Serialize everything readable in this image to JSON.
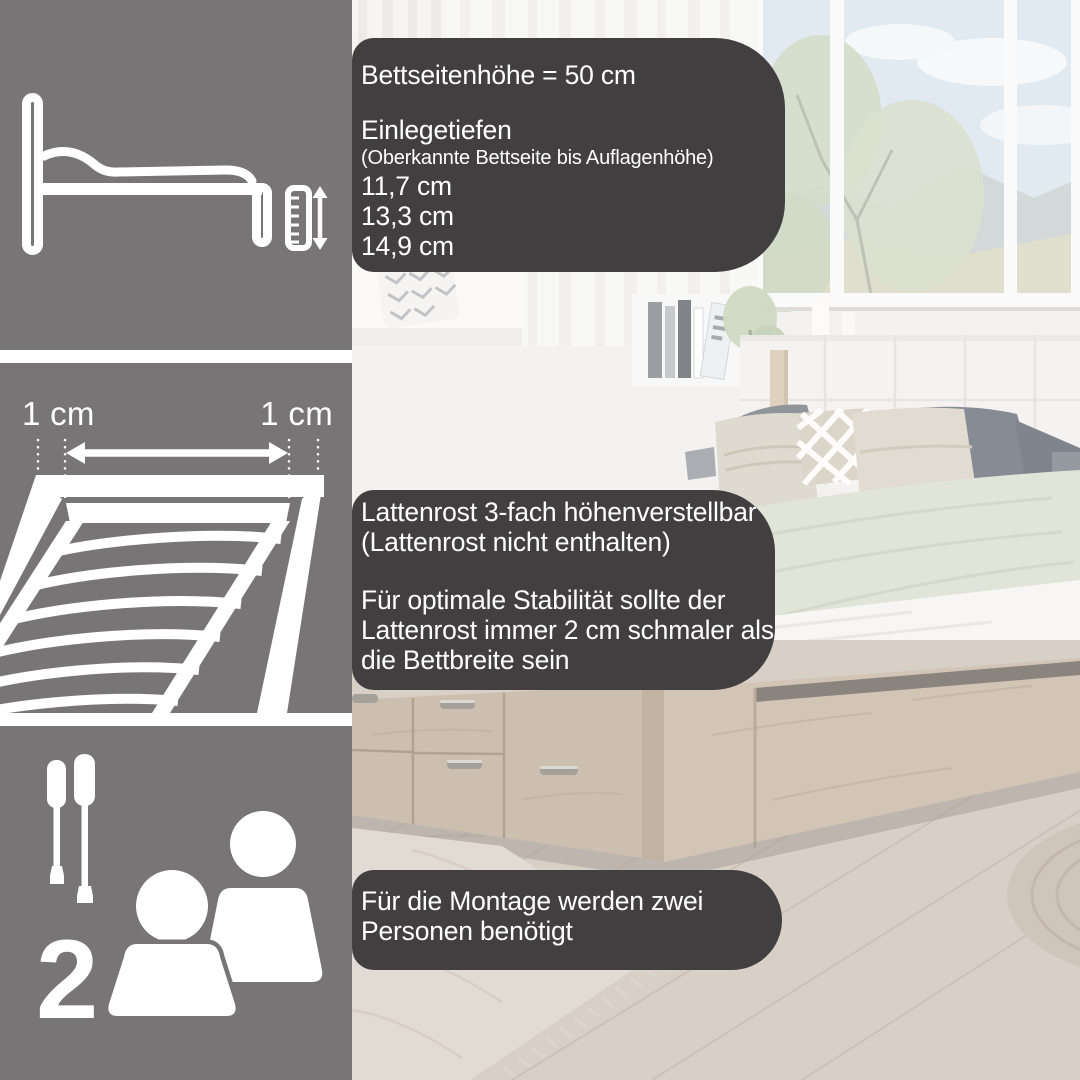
{
  "colors": {
    "panel_bg": "#787577",
    "overlay_bg": "#413f40",
    "icon_color": "#ffffff",
    "text_color": "#ffffff"
  },
  "panels": {
    "bed_height": {
      "icon": "bed-side-view-with-ruler-icon"
    },
    "slatted_frame": {
      "icon": "slatted-frame-perspective-icon",
      "left_label": "1 cm",
      "right_label": "1 cm"
    },
    "assembly": {
      "tools_icon": "screwdrivers-icon",
      "people_icon": "two-persons-icon",
      "person_count": "2"
    }
  },
  "overlays": {
    "bed_side_height": {
      "title": "Bettseitenhöhe = 50 cm",
      "subtitle": "Einlegetiefen",
      "note": "(Oberkannte Bettseite bis Auflagenhöhe)",
      "depths": [
        "11,7 cm",
        "13,3 cm",
        "14,9 cm"
      ]
    },
    "slatted_frame_info": {
      "line1": "Lattenrost 3-fach höhenverstellbar",
      "line2": "(Lattenrost nicht enthalten)",
      "para_line1": "Für optimale Stabilität sollte der",
      "para_line2": "Lattenrost immer 2 cm schmaler als",
      "para_line3": "die Bettbreite sein"
    },
    "assembly_info": {
      "line1": "Für die Montage werden zwei",
      "line2": "Personen benötigt"
    }
  }
}
